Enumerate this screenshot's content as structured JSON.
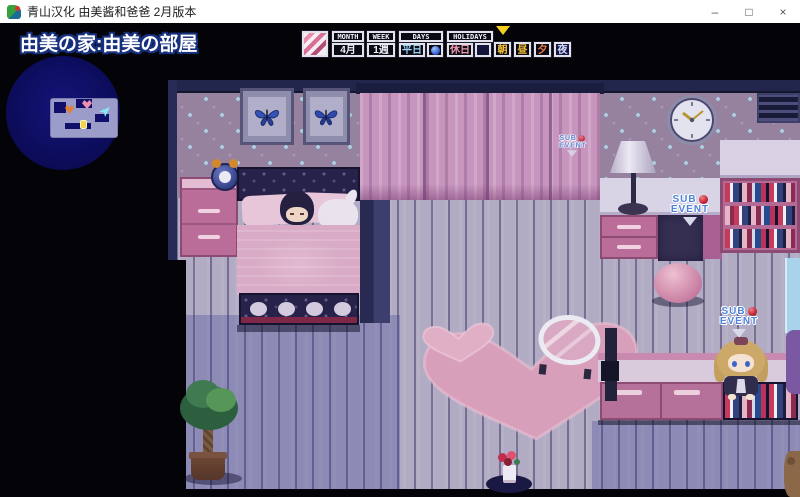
{
  "window": {
    "title": "青山汉化 由美酱和爸爸 2月版本",
    "controls": {
      "minimize": "–",
      "maximize": "□",
      "close": "×"
    }
  },
  "game": {
    "location_label": "由美の家:由美の部屋",
    "hud": {
      "calendar_icon": "diary-calendar-icon",
      "month": {
        "header": "MONTH",
        "value": "4月"
      },
      "week": {
        "header": "WEEK",
        "value": "1週"
      },
      "days": {
        "header": "DAYS",
        "value": "平日",
        "icon": "blue-orb"
      },
      "holidays": {
        "header": "HOLIDAYS",
        "value": "休日",
        "icon": "empty-slot"
      },
      "indicator": "▼",
      "time_slots": [
        {
          "label": "朝",
          "color": "#f6c43a"
        },
        {
          "label": "昼",
          "color": "#f0b83a"
        },
        {
          "label": "夕",
          "color": "#ef7a46"
        },
        {
          "label": "夜",
          "color": "#d7def6"
        }
      ]
    },
    "badges": {
      "sub": "SUB",
      "event": "EVENT"
    },
    "colors": {
      "minimap_circle": "#10106a",
      "wallpaper": "#96819f",
      "curtain": "#c795bd",
      "floor": "#b2abc4",
      "accent_pink": "#bb6d99",
      "sub_event_text": "#4f82d8",
      "sub_event_orb": "#c22334",
      "indicator_yellow": "#f6d021"
    }
  }
}
